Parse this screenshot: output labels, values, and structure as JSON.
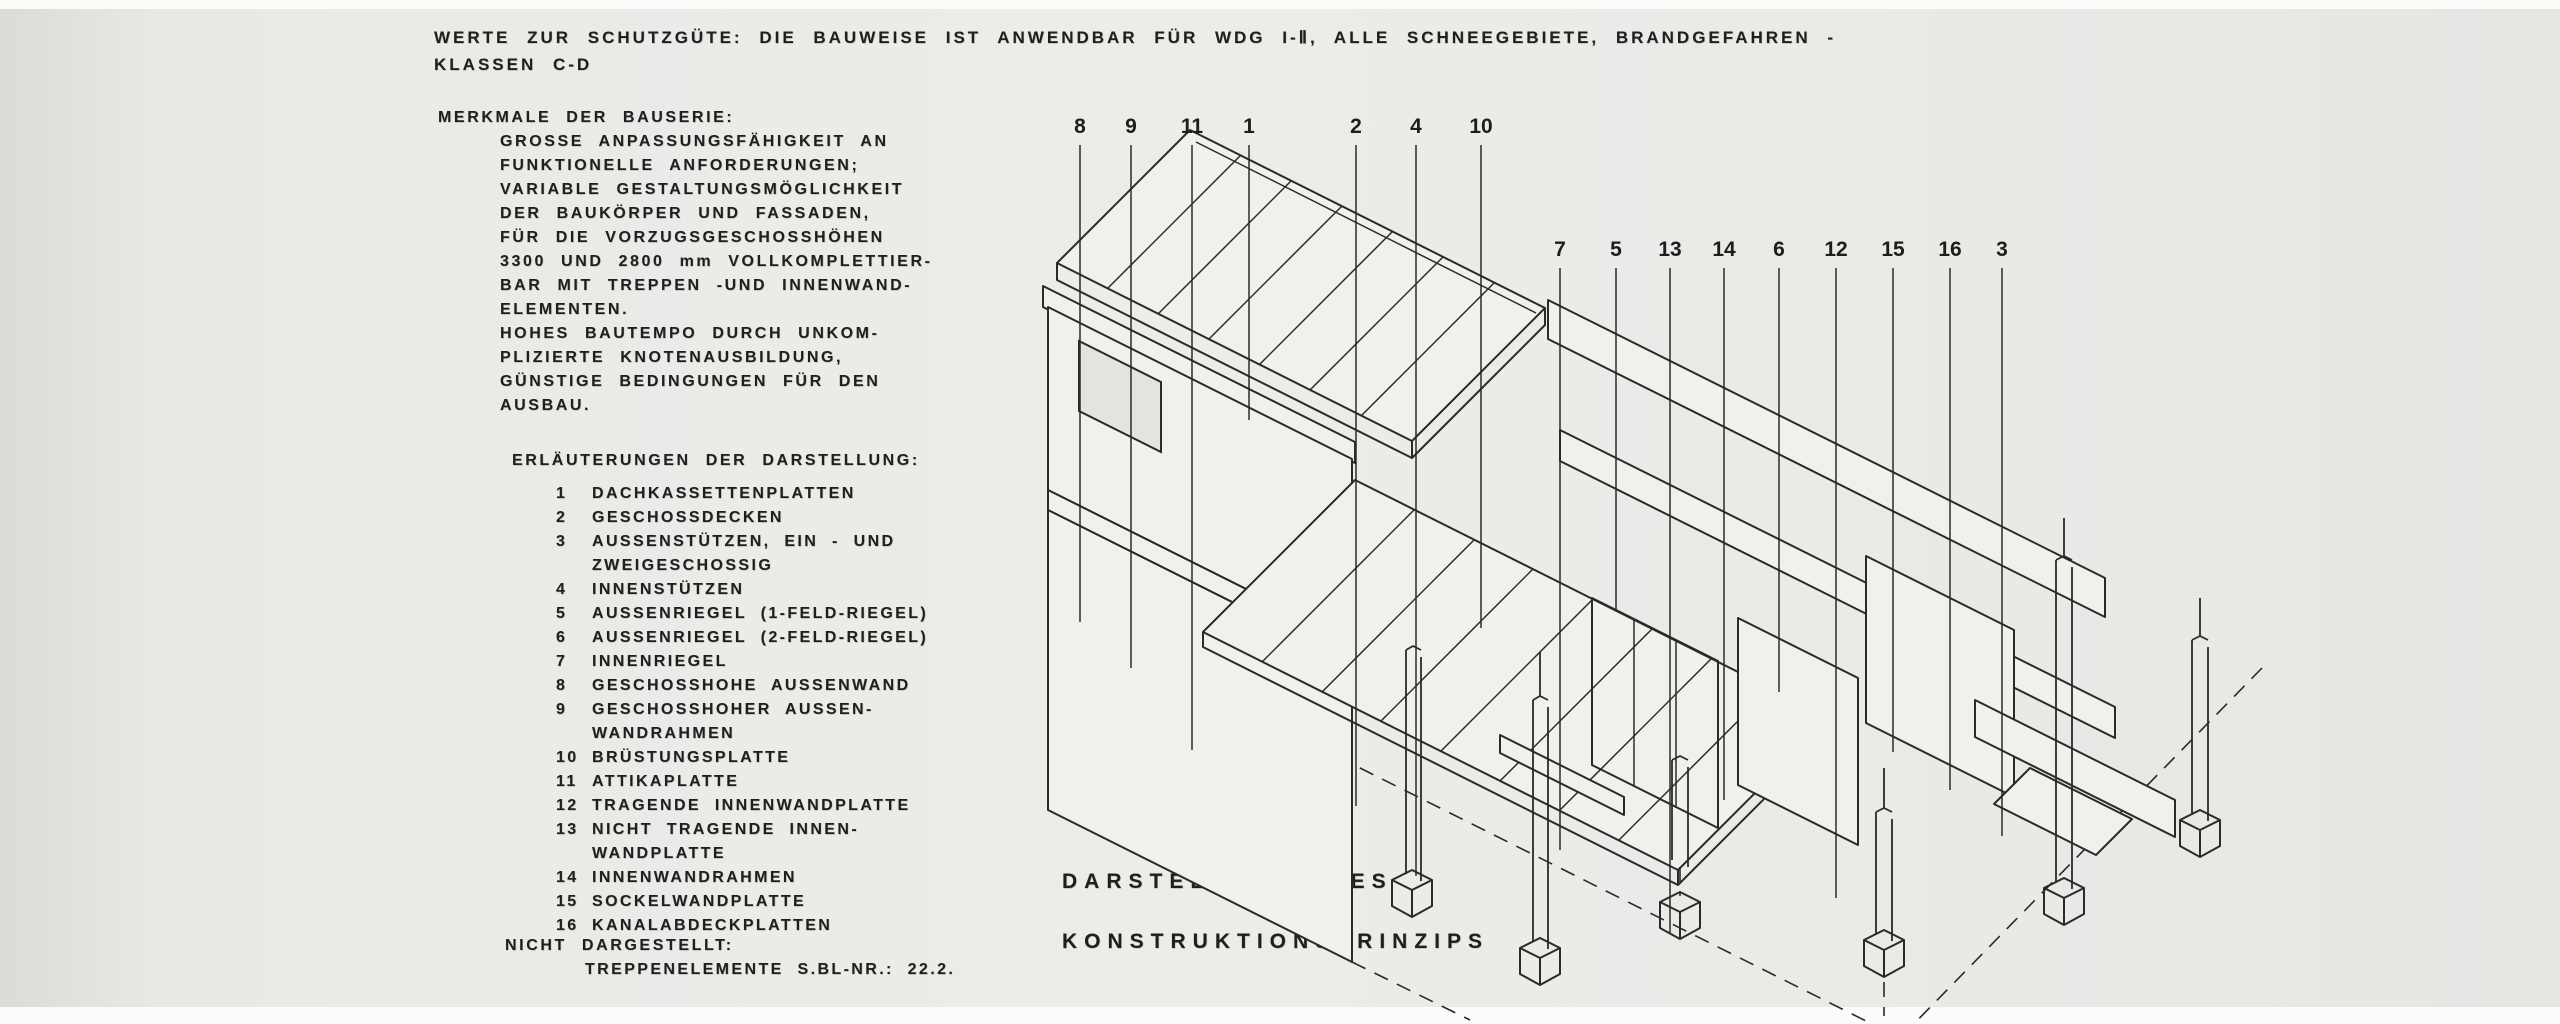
{
  "page": {
    "background": "#ebeae7",
    "ink": "#1f1f1f"
  },
  "header": {
    "line1": "WERTE ZUR SCHUTZGÜTE: DIE BAUWEISE IST ANWENDBAR FÜR WDG I-Ⅱ, ALLE SCHNEEGEBIETE, BRANDGEFAHREN -",
    "line2": "KLASSEN C-D"
  },
  "merkmale": {
    "heading": "MERKMALE DER BAUSERIE:",
    "lines": [
      "GROSSE ANPASSUNGSFÄHIGKEIT AN",
      "FUNKTIONELLE ANFORDERUNGEN;",
      "VARIABLE GESTALTUNGSMÖGLICHKEIT",
      "DER BAUKÖRPER UND FASSADEN,",
      "FÜR DIE VORZUGSGESCHOSSHÖHEN",
      "3300 UND 2800 mm VOLLKOMPLETTIER-",
      "BAR MIT TREPPEN -UND INNENWAND-",
      "ELEMENTEN.",
      "HOHES BAUTEMPO DURCH UNKOM-",
      "PLIZIERTE KNOTENAUSBILDUNG,",
      "GÜNSTIGE BEDINGUNGEN FÜR DEN",
      "AUSBAU."
    ]
  },
  "legend": {
    "heading": "ERLÄUTERUNGEN DER DARSTELLUNG:",
    "items": [
      {
        "num": "1",
        "label": "DACHKASSETTENPLATTEN"
      },
      {
        "num": "2",
        "label": "GESCHOSSDECKEN"
      },
      {
        "num": "3",
        "label": "AUSSENSTÜTZEN, EIN - UND\nZWEIGESCHOSSIG"
      },
      {
        "num": "4",
        "label": "INNENSTÜTZEN"
      },
      {
        "num": "5",
        "label": "AUSSENRIEGEL (1-FELD-RIEGEL)"
      },
      {
        "num": "6",
        "label": "AUSSENRIEGEL (2-FELD-RIEGEL)"
      },
      {
        "num": "7",
        "label": "INNENRIEGEL"
      },
      {
        "num": "8",
        "label": "GESCHOSSHOHE AUSSENWAND"
      },
      {
        "num": "9",
        "label": "GESCHOSSHOHER AUSSEN-\nWANDRAHMEN"
      },
      {
        "num": "10",
        "label": "BRÜSTUNGSPLATTE"
      },
      {
        "num": "11",
        "label": "ATTIKAPLATTE"
      },
      {
        "num": "12",
        "label": "TRAGENDE INNENWANDPLATTE"
      },
      {
        "num": "13",
        "label": "NICHT TRAGENDE INNEN-\nWANDPLATTE"
      },
      {
        "num": "14",
        "label": "INNENWANDRAHMEN"
      },
      {
        "num": "15",
        "label": "SOCKELWANDPLATTE"
      },
      {
        "num": "16",
        "label": "KANALABDECKPLATTEN"
      }
    ],
    "footer_heading": "NICHT DARGESTELLT:",
    "footer_text": "TREPPENELEMENTE S.BL-NR.: 22.2."
  },
  "caption": {
    "line1": "DARSTELLUNG DES",
    "line2": "KONSTRUKTIONSPRINZIPS"
  },
  "diagram": {
    "callouts": [
      {
        "n": "8",
        "x": 1080,
        "y": 133,
        "t": 145,
        "b": 622
      },
      {
        "n": "9",
        "x": 1131,
        "y": 133,
        "t": 145,
        "b": 668
      },
      {
        "n": "11",
        "x": 1192,
        "y": 133,
        "t": 145,
        "b": 750
      },
      {
        "n": "1",
        "x": 1249,
        "y": 133,
        "t": 145,
        "b": 420
      },
      {
        "n": "2",
        "x": 1356,
        "y": 133,
        "t": 145,
        "b": 806
      },
      {
        "n": "4",
        "x": 1416,
        "y": 133,
        "t": 145,
        "b": 876
      },
      {
        "n": "10",
        "x": 1481,
        "y": 133,
        "t": 145,
        "b": 628
      },
      {
        "n": "7",
        "x": 1560,
        "y": 256,
        "t": 268,
        "b": 850
      },
      {
        "n": "5",
        "x": 1616,
        "y": 256,
        "t": 268,
        "b": 610
      },
      {
        "n": "13",
        "x": 1670,
        "y": 256,
        "t": 268,
        "b": 934
      },
      {
        "n": "14",
        "x": 1724,
        "y": 256,
        "t": 268,
        "b": 800
      },
      {
        "n": "6",
        "x": 1779,
        "y": 256,
        "t": 268,
        "b": 692
      },
      {
        "n": "12",
        "x": 1836,
        "y": 256,
        "t": 268,
        "b": 898
      },
      {
        "n": "15",
        "x": 1893,
        "y": 256,
        "t": 268,
        "b": 752
      },
      {
        "n": "16",
        "x": 1950,
        "y": 256,
        "t": 268,
        "b": 790
      },
      {
        "n": "3",
        "x": 2002,
        "y": 256,
        "t": 268,
        "b": 836
      }
    ]
  }
}
